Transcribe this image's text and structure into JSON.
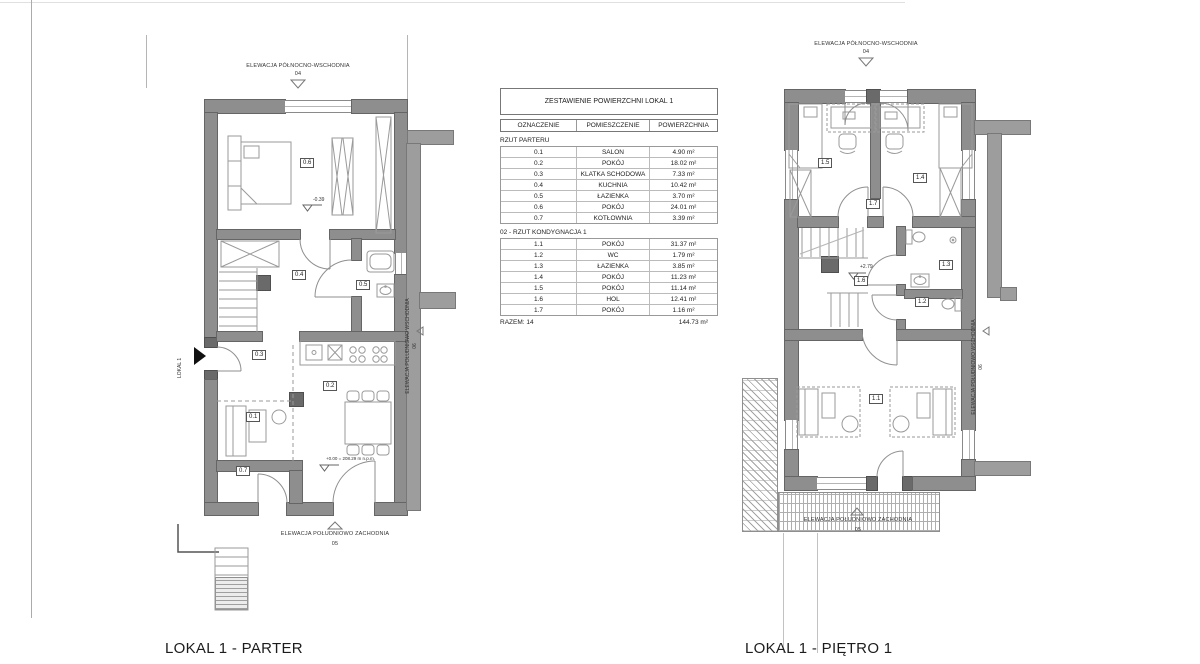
{
  "sheet": {
    "caption_parter": "LOKAL 1 - PARTER",
    "caption_pietro": "LOKAL 1 - PIĘTRO 1"
  },
  "table": {
    "title": "ZESTAWIENIE POWIERZCHNI LOKAL 1",
    "columns": [
      "OZNACZENIE",
      "POMIESZCZENIE",
      "POWIERZCHNIA"
    ],
    "sections": [
      {
        "label": "RZUT PARTERU",
        "rows": [
          [
            "0.1",
            "SALON",
            "4.90 m²"
          ],
          [
            "0.2",
            "POKÓJ",
            "18.02 m²"
          ],
          [
            "0.3",
            "KLATKA SCHODOWA",
            "7.33 m²"
          ],
          [
            "0.4",
            "KUCHNIA",
            "10.42 m²"
          ],
          [
            "0.5",
            "ŁAZIENKA",
            "3.70 m²"
          ],
          [
            "0.6",
            "POKÓJ",
            "24.01 m²"
          ],
          [
            "0.7",
            "KOTŁOWNIA",
            "3.39 m²"
          ]
        ]
      },
      {
        "label": "02 - RZUT  KONDYGNACJA 1",
        "rows": [
          [
            "1.1",
            "POKÓJ",
            "31.37 m²"
          ],
          [
            "1.2",
            "WC",
            "1.79 m²"
          ],
          [
            "1.3",
            "ŁAZIENKA",
            "3.85 m²"
          ],
          [
            "1.4",
            "POKÓJ",
            "11.23 m²"
          ],
          [
            "1.5",
            "POKÓJ",
            "11.14 m²"
          ],
          [
            "1.6",
            "HOL",
            "12.41 m²"
          ],
          [
            "1.7",
            "POKÓJ",
            "1.16 m²"
          ]
        ]
      }
    ],
    "total_label": "RAZEM: 14",
    "total_value": "144.73 m²"
  },
  "parter": {
    "unit_label": "LOKAL 1",
    "elevations": {
      "top": {
        "name": "ELEWACJA PÓŁNOCNO-WSCHODNIA",
        "number": "04"
      },
      "bottom": {
        "name": "ELEWACJA POŁUDNIOWO ZACHODNIA",
        "number": "05"
      },
      "side": {
        "name": "ELEWACJA POŁUDNIOWO WSCHODNIA",
        "number": "06"
      }
    },
    "levels": {
      "bedroom": "-0.39",
      "entry": "+0.00 = 208.29 m n.p.m."
    },
    "rooms": {
      "r01": "0.1",
      "r02": "0.2",
      "r03": "0.3",
      "r04": "0.4",
      "r05": "0.5",
      "r06": "0.6",
      "r07": "0.7"
    }
  },
  "pietro": {
    "elevations": {
      "top": {
        "name": "ELEWACJA PÓŁNOCNO-WSCHODNIA",
        "number": "04"
      },
      "bottom": {
        "name": "ELEWACJA POŁUDNIOWO ZACHODNIA",
        "number": "05"
      },
      "side": {
        "name": "ELEWACJA POŁUDNIOWO WSCHODNIA",
        "number": "06"
      }
    },
    "levels": {
      "hall": "+2.79"
    },
    "rooms": {
      "r11": "1.1",
      "r12": "1.2",
      "r13": "1.3",
      "r14": "1.4",
      "r15": "1.5",
      "r16": "1.6",
      "r17": "1.7"
    }
  }
}
